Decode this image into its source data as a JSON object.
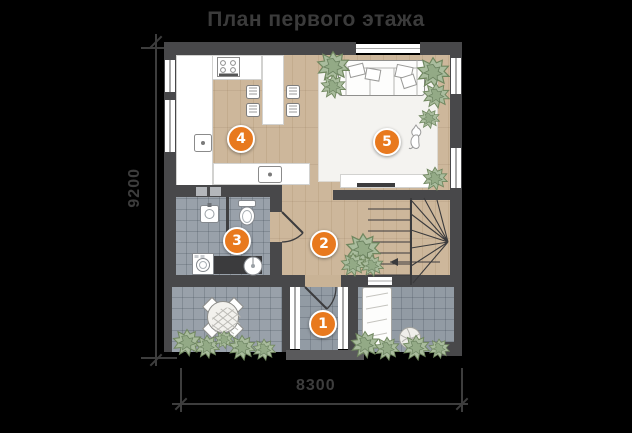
{
  "title": "План первого этажа",
  "dimensions": {
    "height": "9200",
    "width": "8300"
  },
  "rooms": [
    {
      "number": "1"
    },
    {
      "number": "2"
    },
    {
      "number": "3"
    },
    {
      "number": "4"
    },
    {
      "number": "5"
    }
  ],
  "colors": {
    "accent_orange": "#e8791e",
    "wall": "#48484a",
    "wood_floor": "#cdb79b",
    "bathroom_tile": "#99a1aa",
    "terrace_tile": "#939ca5",
    "rug": "#f4f3f0",
    "background": "#000000",
    "annotation": "#3d3d3d"
  }
}
